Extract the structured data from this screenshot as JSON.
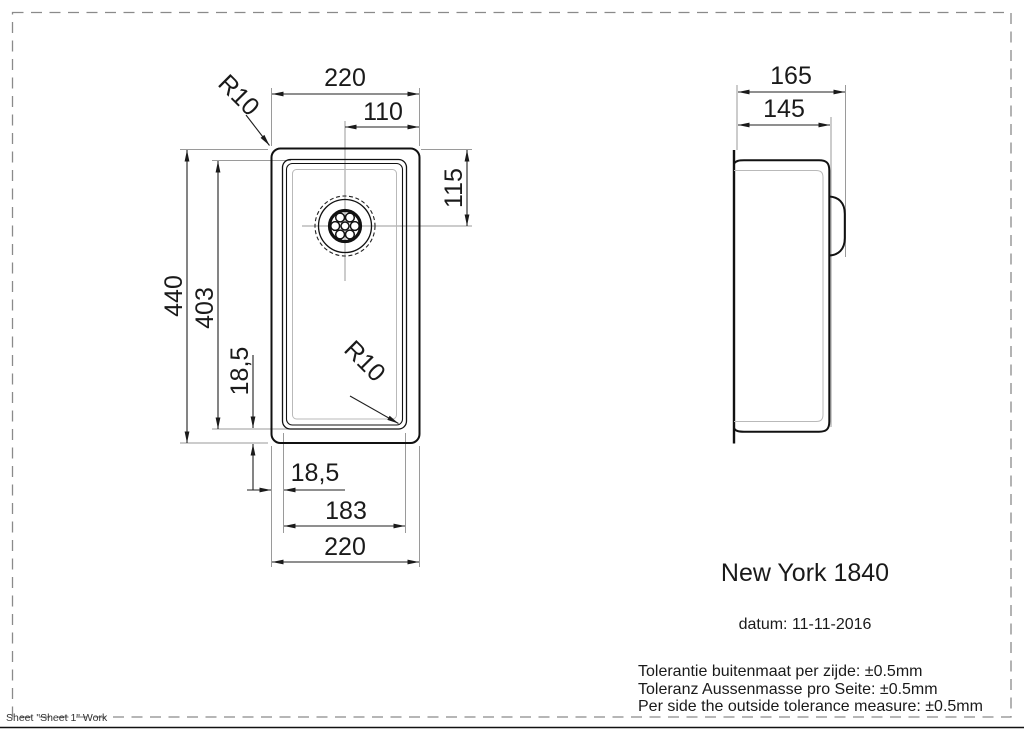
{
  "drawing": {
    "product": "New York 1840",
    "date": "datum: 11-11-2016",
    "tolerance_lines": [
      "Tolerantie buitenmaat per zijde: ±0.5mm",
      "Toleranz Aussenmasse pro Seite: ±0.5mm",
      "Per side the outside tolerance measure: ±0.5mm"
    ],
    "sheet_label": "Sheet \"Sheet 1\" Work"
  },
  "top_view": {
    "width_top": "220",
    "drain_offset": "110",
    "radius_outer": "R10",
    "radius_inner": "R10",
    "drain_from_top": "115",
    "height_outer": "440",
    "height_inner": "403",
    "rim_left": "18,5",
    "rim_bottom": "18,5",
    "width_inner": "183",
    "width_bottom": "220"
  },
  "side_view": {
    "depth_outer": "165",
    "depth_inner": "145"
  }
}
